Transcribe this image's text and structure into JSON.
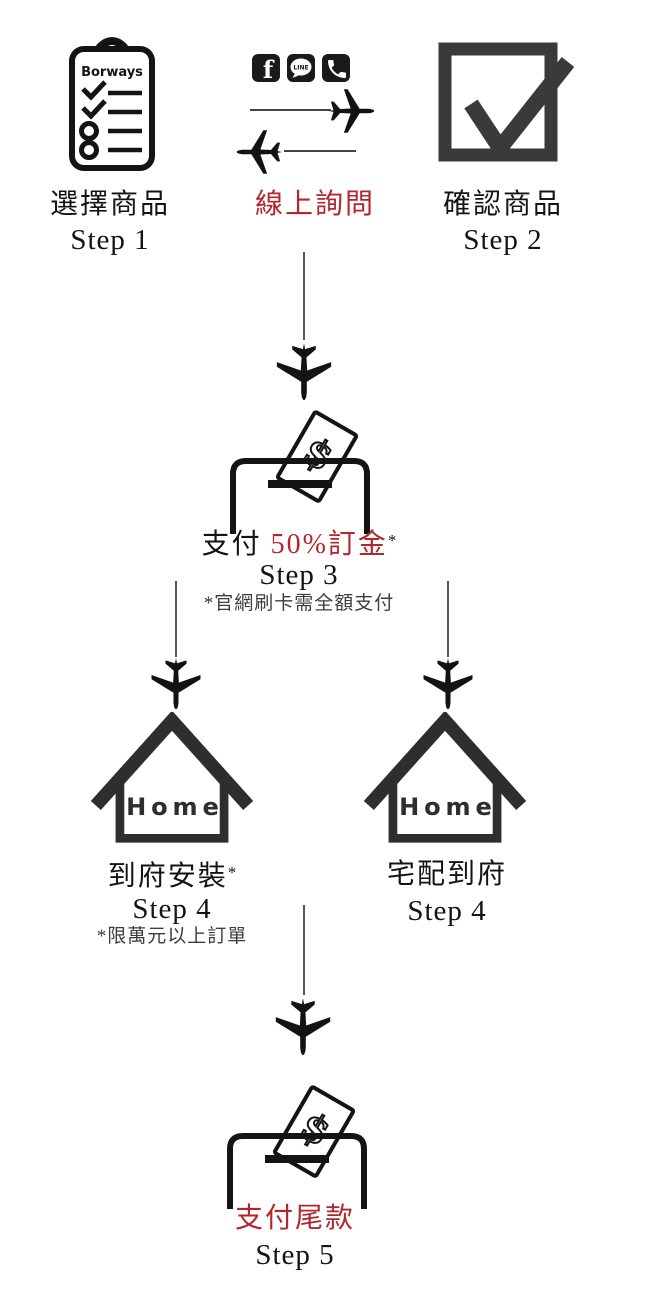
{
  "colors": {
    "accent_red": "#B3262C",
    "ink": "#141414",
    "icon_gray": "#3A3A3A",
    "note_gray": "#3D3D3D"
  },
  "icons": {
    "clipboard_brand": "Borways",
    "facebook_letter": "f",
    "line_text": "LINE",
    "home_text": "Home",
    "dollar": "$"
  },
  "flow": {
    "step1": {
      "label": "選擇商品",
      "step": "Step 1"
    },
    "inquiry": {
      "label": "線上詢問"
    },
    "step2": {
      "label": "確認商品",
      "step": "Step 2"
    },
    "step3": {
      "pay_prefix": "支付 ",
      "deposit": "50%訂金",
      "asterisk": "*",
      "step": "Step 3",
      "note": "*官網刷卡需全額支付"
    },
    "step4_install": {
      "label": "到府安裝",
      "asterisk": "*",
      "step": "Step 4",
      "note": "*限萬元以上訂單"
    },
    "step4_delivery": {
      "label": "宅配到府",
      "step": "Step 4"
    },
    "step5": {
      "label": "支付尾款",
      "step": "Step 5"
    }
  }
}
